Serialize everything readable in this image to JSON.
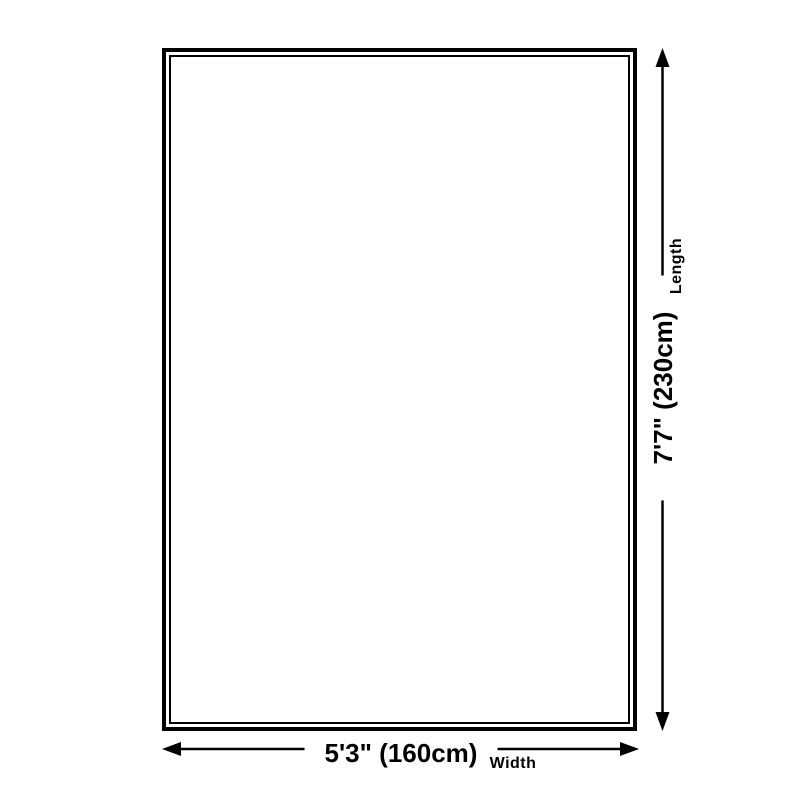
{
  "diagram": {
    "title": "rug-dimension-diagram",
    "background_color": "#ffffff",
    "line_color": "#000000",
    "rug": {
      "border_style": "double-rectangle"
    },
    "length": {
      "value": "7'7\" (230cm)",
      "label": "Length"
    },
    "width": {
      "value": "5'3\" (160cm)",
      "label": "Width"
    }
  }
}
